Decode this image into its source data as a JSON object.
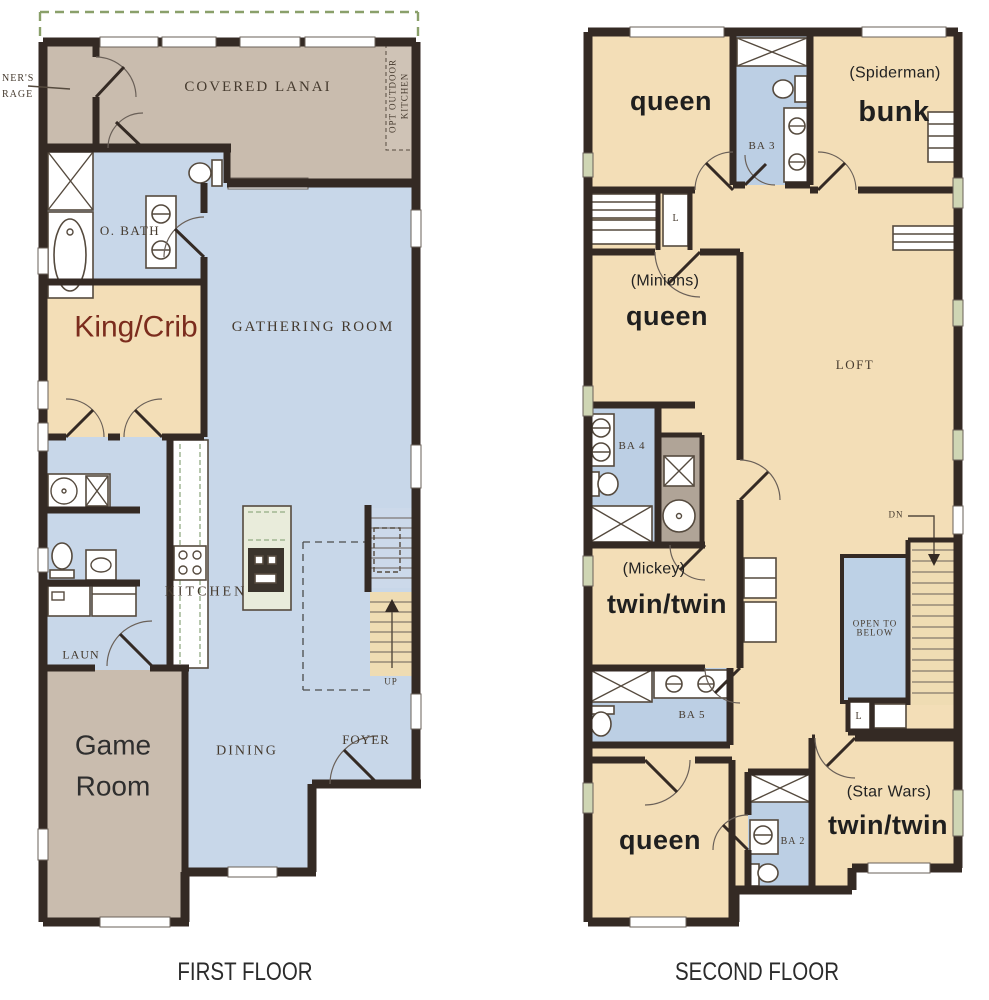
{
  "meta": {
    "figure_type": "floor-plan",
    "panels": 2
  },
  "colors": {
    "wall": "#342a24",
    "ink": "#453a2e",
    "bedroom": "#f3deb7",
    "living": "#c8d7e9",
    "bath": "#bccfe4",
    "utility": "#c9bcae",
    "closet": "#b0a497",
    "stair": "#efdcb3",
    "open_below": "#bdd1e6",
    "screen": "#8aa06a",
    "accent": "#7b2c1d",
    "label": "#1f1f1f",
    "window_sill": "#cfd6b4"
  },
  "first_floor": {
    "caption": "FIRST FLOOR",
    "labels": {
      "garage_callout_line1": "NER'S",
      "garage_callout_line2": "RAGE",
      "covered_lanai": "COVERED LANAI",
      "opt_kitchen_line1": "OPT OUTDOOR",
      "opt_kitchen_line2": "KITCHEN",
      "owners_bath": "O. BATH",
      "king_crib": "King/Crib",
      "gathering_room": "GATHERING ROOM",
      "kitchen": "KITCHEN",
      "laundry": "LAUN",
      "game_room_line1": "Game",
      "game_room_line2": "Room",
      "dining": "DINING",
      "foyer": "FOYER",
      "up": "UP"
    }
  },
  "second_floor": {
    "caption": "SECOND FLOOR",
    "labels": {
      "bedroom_queen_top": "queen",
      "bath3": "BA 3",
      "theme_spiderman": "(Spiderman)",
      "bedroom_bunk": "bunk",
      "linen_closet_1": "L",
      "theme_minions": "(Minions)",
      "bedroom_queen_mid": "queen",
      "loft": "LOFT",
      "bath4": "BA 4",
      "down": "DN",
      "theme_mickey": "(Mickey)",
      "bedroom_twin_mid": "twin/twin",
      "open_to_below_line1": "OPEN TO",
      "open_to_below_line2": "BELOW",
      "linen_closet_2": "L",
      "bath5": "BA 5",
      "bedroom_queen_bottom": "queen",
      "bath2": "BA 2",
      "theme_starwars": "(Star Wars)",
      "bedroom_twin_bottom": "twin/twin"
    }
  }
}
